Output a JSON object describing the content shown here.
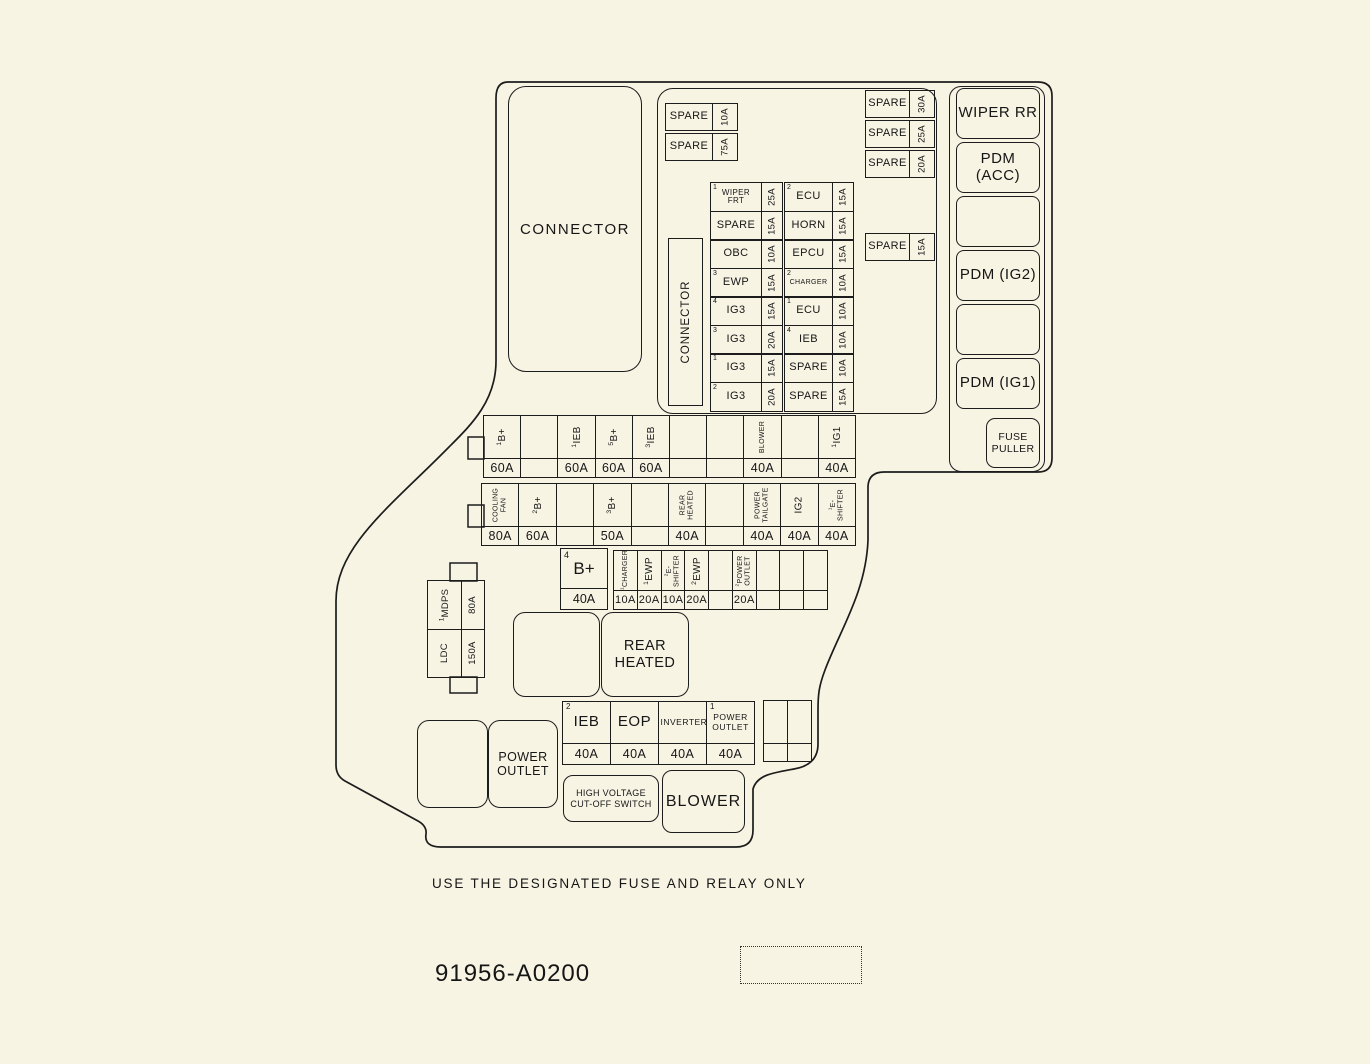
{
  "colors": {
    "background": "#F7F4E4",
    "line": "#1C1C1C"
  },
  "top_area": {
    "main_connector": "CONNECTOR",
    "vertical_connector": "CONNECTOR",
    "left_spares": [
      {
        "sup": "",
        "label": "SPARE",
        "amp": "10A"
      },
      {
        "sup": "",
        "label": "SPARE",
        "amp": "75A"
      }
    ],
    "right_spares": [
      {
        "sup": "",
        "label": "SPARE",
        "amp": "30A"
      },
      {
        "sup": "",
        "label": "SPARE",
        "amp": "25A"
      },
      {
        "sup": "",
        "label": "SPARE",
        "amp": "20A"
      }
    ],
    "mid_spare": [
      {
        "sup": "",
        "label": "SPARE",
        "amp": "15A"
      }
    ]
  },
  "fuse_grid": {
    "col_a": [
      {
        "sup": "1",
        "label": "WIPER FRT",
        "amp": "25A"
      },
      {
        "sup": "",
        "label": "SPARE",
        "amp": "15A"
      },
      {
        "sup": "",
        "label": "OBC",
        "amp": "10A"
      },
      {
        "sup": "3",
        "label": "EWP",
        "amp": "15A"
      },
      {
        "sup": "4",
        "label": "IG3",
        "amp": "15A"
      },
      {
        "sup": "3",
        "label": "IG3",
        "amp": "20A"
      },
      {
        "sup": "1",
        "label": "IG3",
        "amp": "15A"
      },
      {
        "sup": "2",
        "label": "IG3",
        "amp": "20A"
      }
    ],
    "col_b": [
      {
        "sup": "2",
        "label": "ECU",
        "amp": "15A"
      },
      {
        "sup": "",
        "label": "HORN",
        "amp": "15A"
      },
      {
        "sup": "",
        "label": "EPCU",
        "amp": "15A"
      },
      {
        "sup": "2",
        "label": "CHARGER",
        "amp": "10A"
      },
      {
        "sup": "1",
        "label": "ECU",
        "amp": "10A"
      },
      {
        "sup": "4",
        "label": "IEB",
        "amp": "10A"
      },
      {
        "sup": "",
        "label": "SPARE",
        "amp": "10A"
      },
      {
        "sup": "",
        "label": "SPARE",
        "amp": "15A"
      }
    ]
  },
  "right_column": {
    "boxes": [
      "WIPER RR",
      "PDM (ACC)",
      "",
      "PDM (IG2)",
      "",
      "PDM (IG1)"
    ],
    "fuse_puller": "FUSE PULLER"
  },
  "relay_row1": [
    {
      "sup": "1",
      "label": "B+",
      "amp": "60A"
    },
    {
      "sup": "",
      "label": "",
      "amp": ""
    },
    {
      "sup": "1",
      "label": "IEB",
      "amp": "60A"
    },
    {
      "sup": "5",
      "label": "B+",
      "amp": "60A"
    },
    {
      "sup": "3",
      "label": "IEB",
      "amp": "60A"
    },
    {
      "sup": "",
      "label": "",
      "amp": ""
    },
    {
      "sup": "",
      "label": "",
      "amp": ""
    },
    {
      "sup": "",
      "label": "BLOWER",
      "amp": "40A"
    },
    {
      "sup": "",
      "label": "",
      "amp": ""
    },
    {
      "sup": "1",
      "label": "IG1",
      "amp": "40A"
    }
  ],
  "relay_row2": [
    {
      "sup": "",
      "label": "COOLING FAN",
      "amp": "80A"
    },
    {
      "sup": "2",
      "label": "B+",
      "amp": "60A"
    },
    {
      "sup": "",
      "label": "",
      "amp": ""
    },
    {
      "sup": "3",
      "label": "B+",
      "amp": "50A"
    },
    {
      "sup": "",
      "label": "",
      "amp": ""
    },
    {
      "sup": "",
      "label": "REAR HEATED",
      "amp": "40A"
    },
    {
      "sup": "",
      "label": "",
      "amp": ""
    },
    {
      "sup": "",
      "label": "POWER TAILGATE",
      "amp": "40A"
    },
    {
      "sup": "",
      "label": "IG2",
      "amp": "40A"
    },
    {
      "sup": "1",
      "label": "E- SHIFTER",
      "amp": "40A"
    }
  ],
  "row3": {
    "big_fuse": {
      "sup": "4",
      "label": "B+",
      "amp": "40A"
    },
    "strip": [
      {
        "sup": "1",
        "label": "CHARGER",
        "amp": "10A"
      },
      {
        "sup": "1",
        "label": "EWP",
        "amp": "20A"
      },
      {
        "sup": "2",
        "label": "E- SHIFTER",
        "amp": "10A"
      },
      {
        "sup": "2",
        "label": "EWP",
        "amp": "20A"
      },
      {
        "sup": "",
        "label": "",
        "amp": ""
      },
      {
        "sup": "2",
        "label": "POWER OUTLET",
        "amp": "20A"
      },
      {
        "sup": "",
        "label": "",
        "amp": ""
      },
      {
        "sup": "",
        "label": "",
        "amp": ""
      },
      {
        "sup": "",
        "label": "",
        "amp": ""
      }
    ]
  },
  "side_block": {
    "top": {
      "sup": "1",
      "label": "MDPS",
      "amp": "80A"
    },
    "bottom": {
      "sup": "",
      "label": "LDC",
      "amp": "150A"
    }
  },
  "mid_boxes": {
    "rear_heated": "REAR HEATED",
    "power_outlet": "POWER OUTLET"
  },
  "bottom_row": [
    {
      "sup": "2",
      "label": "IEB",
      "amp": "40A"
    },
    {
      "sup": "",
      "label": "EOP",
      "amp": "40A"
    },
    {
      "sup": "",
      "label": "INVERTER",
      "amp": "40A"
    },
    {
      "sup": "1",
      "label": "POWER OUTLET",
      "amp": "40A"
    }
  ],
  "bottom_boxes": {
    "hv_switch_line1": "HIGH VOLTAGE",
    "hv_switch_line2": "CUT-OFF SWITCH",
    "blower": "BLOWER"
  },
  "footer": {
    "warning": "USE THE DESIGNATED FUSE AND RELAY ONLY",
    "part_number": "91956-A0200"
  }
}
